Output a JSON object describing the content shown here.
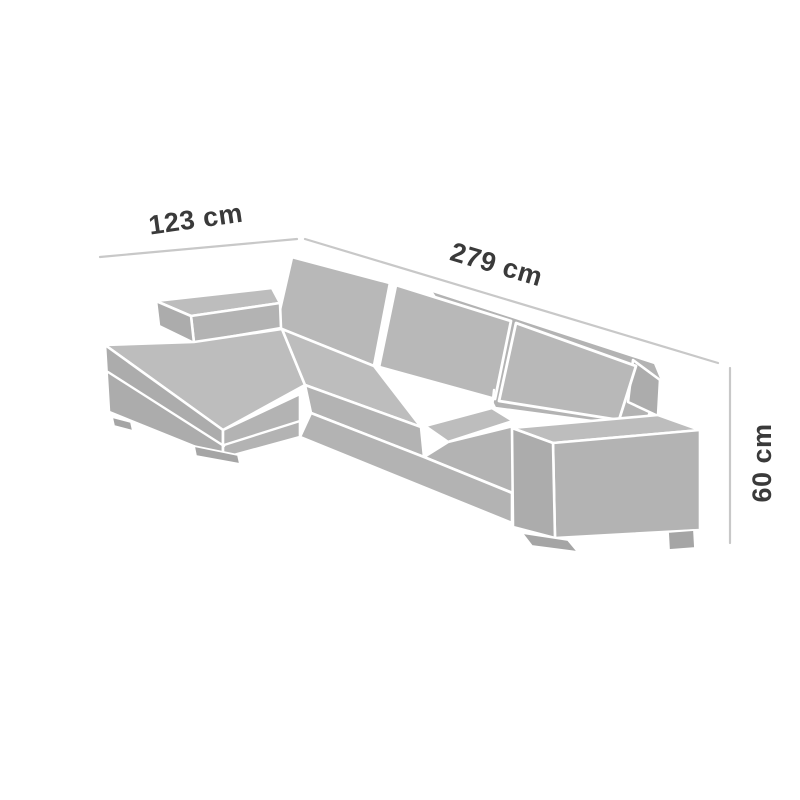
{
  "figure": {
    "kind": "product-dimension-diagram",
    "subject": "sectional sofa with left chaise",
    "dimensions": {
      "chaise_depth": {
        "label": "123 cm",
        "value": 123,
        "unit": "cm"
      },
      "total_width": {
        "label": "279 cm",
        "value": 279,
        "unit": "cm"
      },
      "height": {
        "label": "60 cm",
        "value": 60,
        "unit": "cm"
      }
    },
    "colors": {
      "background": "#ffffff",
      "sofa_top": "#bdbdbd",
      "sofa_front": "#b3b3b3",
      "sofa_side": "#acacac",
      "sofa_cushion": "#b8b8b8",
      "legs": "#a5a5a5",
      "seam": "#ffffff",
      "dimension_line": "#c8c8c8",
      "label_text": "#3a3a3a"
    }
  }
}
